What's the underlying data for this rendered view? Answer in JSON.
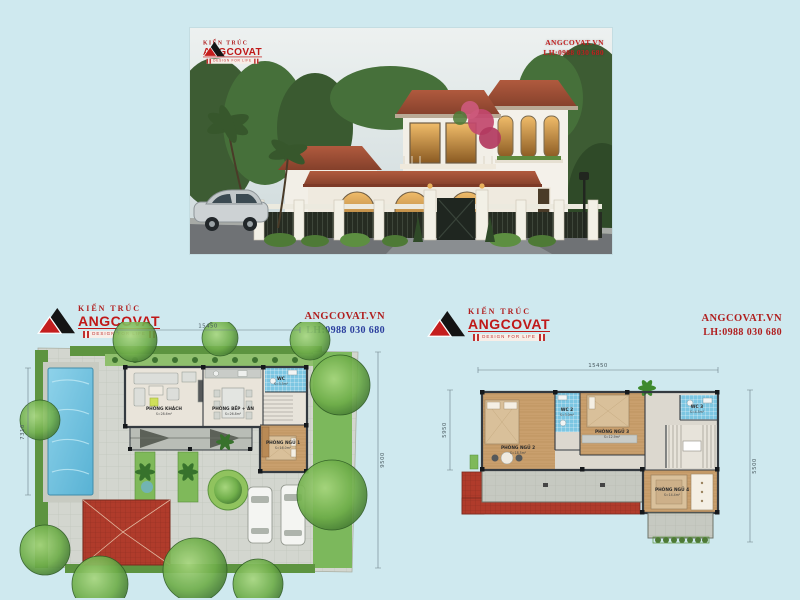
{
  "page": {
    "background": "#cfe9ef"
  },
  "brand": {
    "logo_top": "KIẾN TRÚC",
    "logo_name": "ANGCOVAT",
    "logo_tagline": "DESIGN FOR LIFE",
    "website": "ANGCOVAT.VN",
    "phone": "LH:0988 030 680",
    "red": "#b01f1f",
    "blue": "#2b3f9e"
  },
  "plans": {
    "ground": {
      "dim_width": "15450",
      "dim_left": "7310",
      "dim_right": "9500",
      "rooms": [
        {
          "name": "PHÒNG KHÁCH",
          "area": "S=28.6m²"
        },
        {
          "name": "PHÒNG BẾP + ĂN",
          "area": "S=26.8m²"
        },
        {
          "name": "WC",
          "area": "S=3.5m²"
        },
        {
          "name": "PHÒNG NGỦ 1",
          "area": "S=16.0m²"
        }
      ]
    },
    "floor2": {
      "dim_width": "15450",
      "dim_left": "5950",
      "dim_right": "5500",
      "rooms": [
        {
          "name": "PHÒNG NGỦ 2",
          "area": "S=18.5m²"
        },
        {
          "name": "WC 2",
          "area": "S=3.0m²"
        },
        {
          "name": "PHÒNG NGỦ 3",
          "area": "S=12.9m²"
        },
        {
          "name": "WC 3",
          "area": "S=4.5m²"
        },
        {
          "name": "PHÒNG NGỦ 4",
          "area": "S=14.4m²"
        }
      ]
    }
  },
  "colors": {
    "roof_render": "#a64a33",
    "pool": "#6fc1de",
    "tree": "#5e9c40",
    "paving": "#d3d6cf",
    "wood_floor": "#c99f6d",
    "wc_tile": "#7cc6e2",
    "plan_roof_red": "#b03b2b"
  }
}
